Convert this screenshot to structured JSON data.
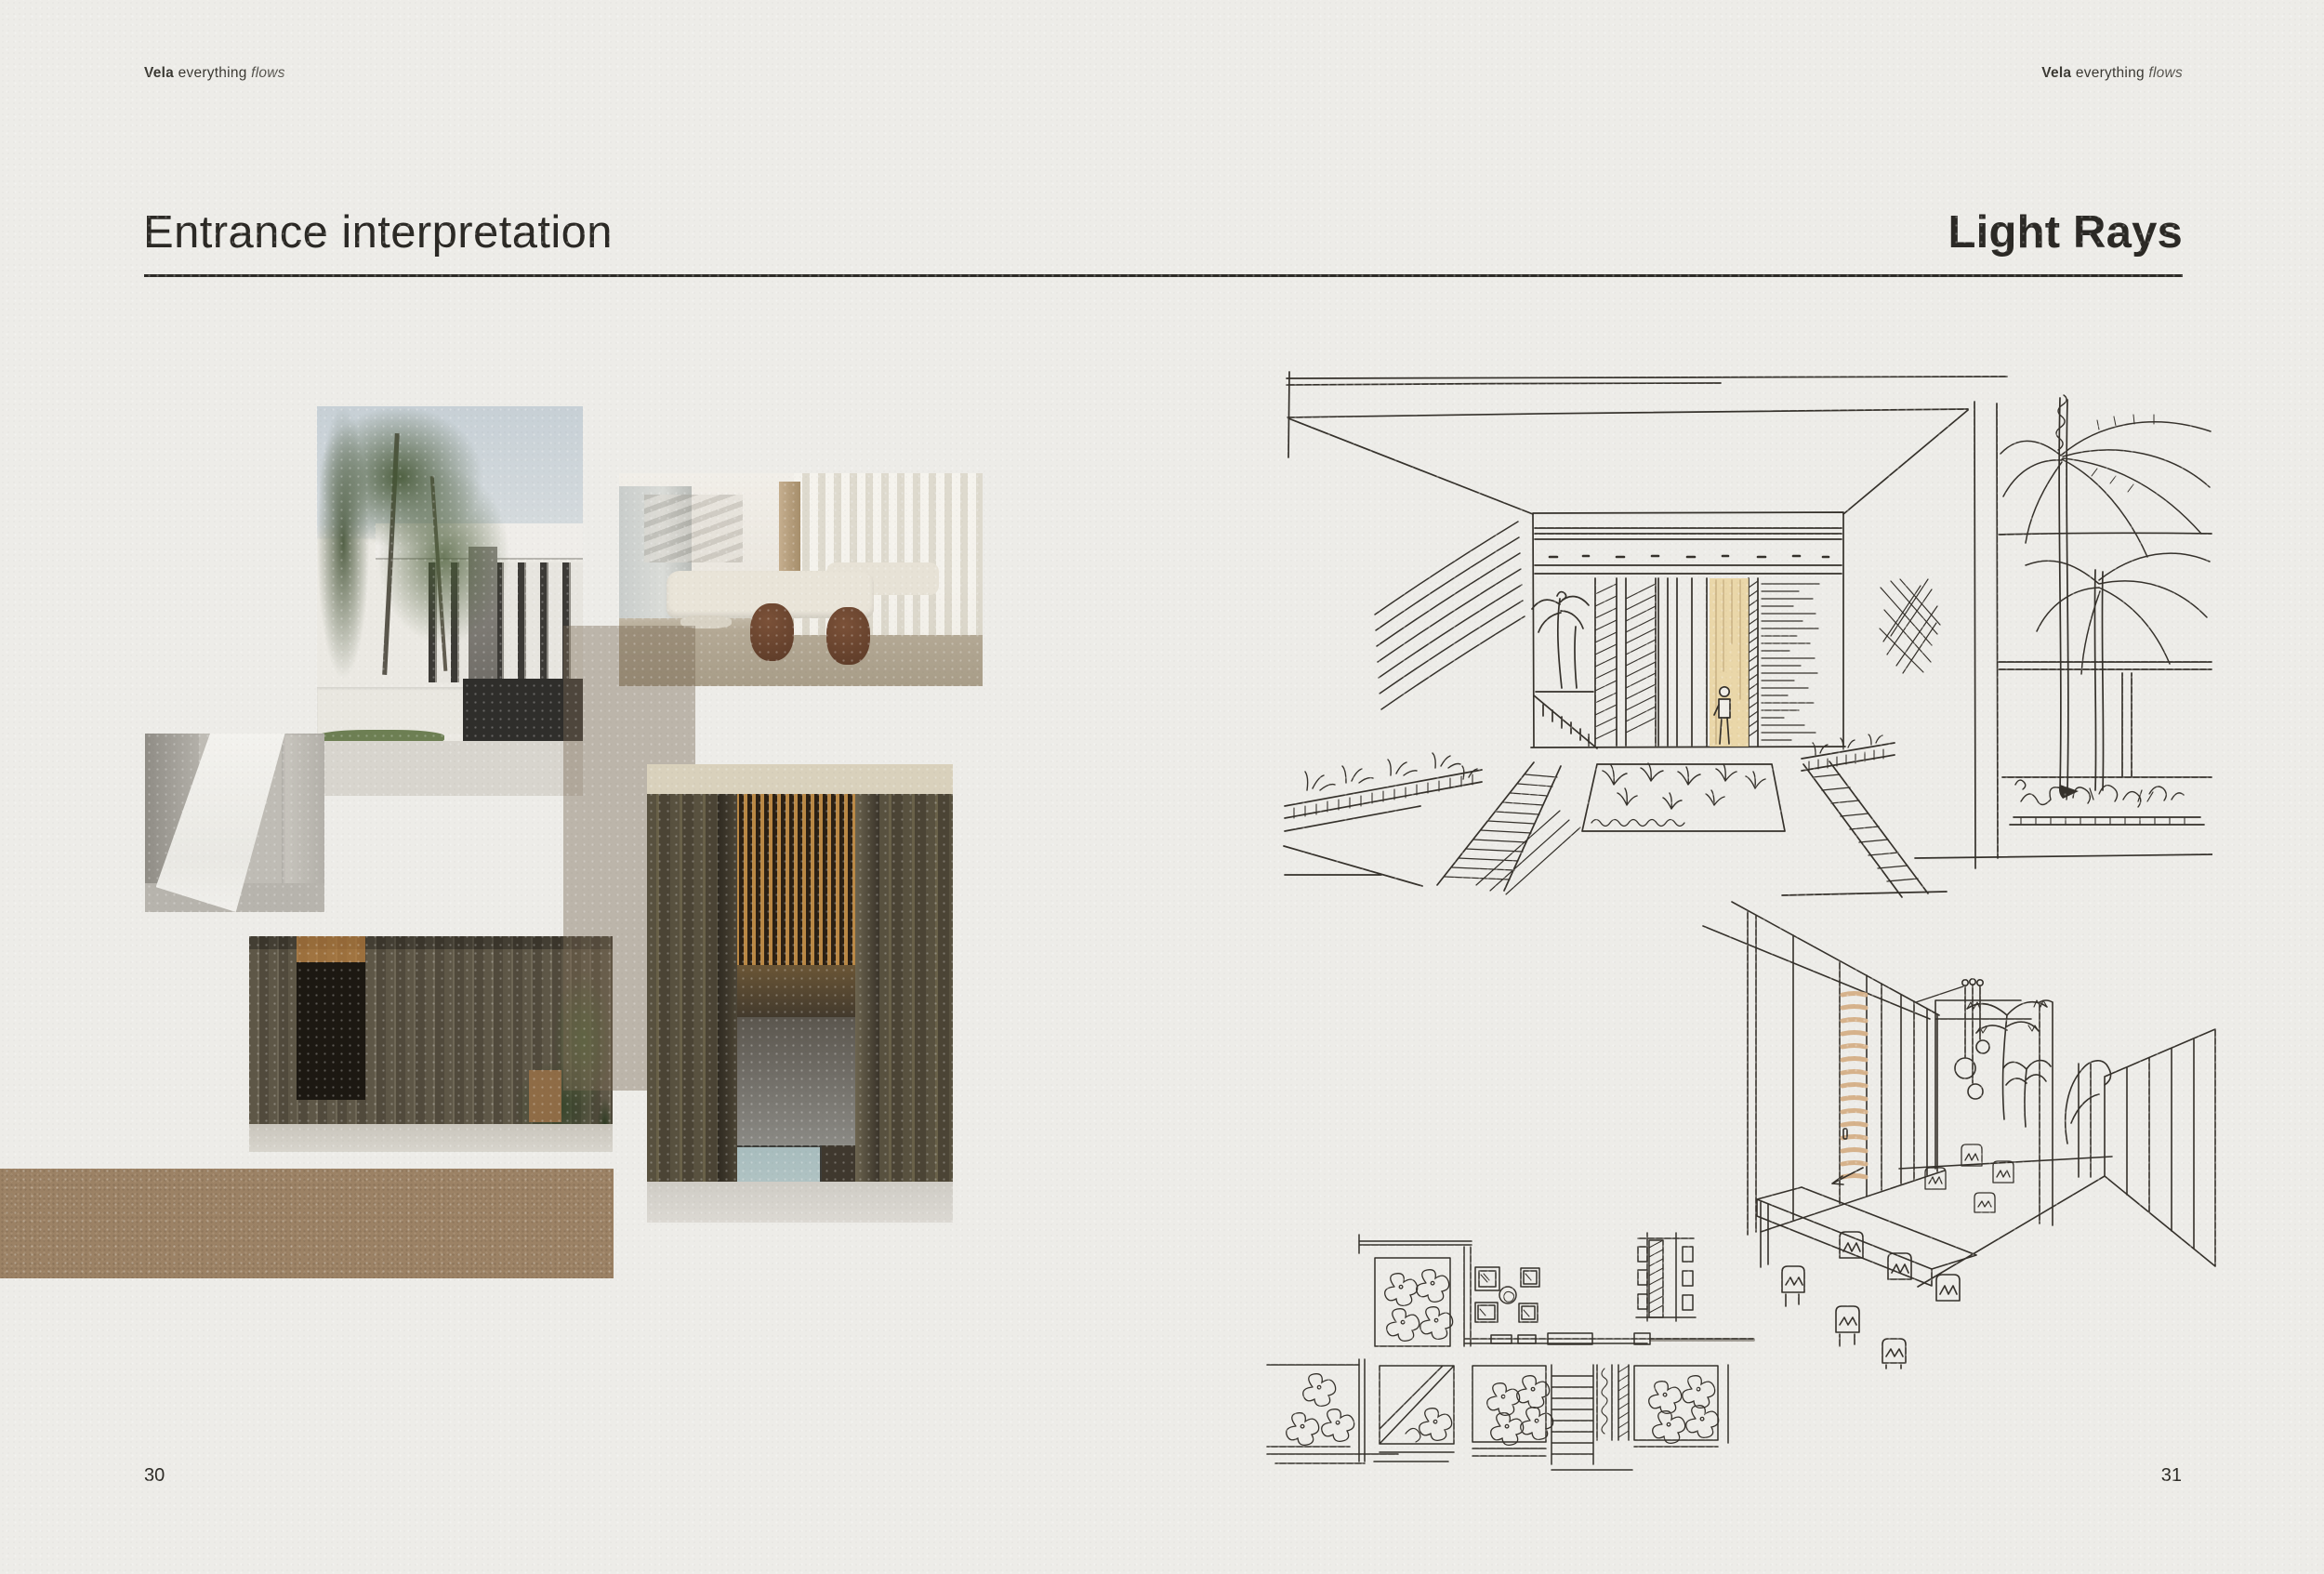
{
  "spread": {
    "left_page": {
      "logo": {
        "brand": "Vela",
        "tagline_word": "everything",
        "tagline_italic": "flows"
      },
      "heading": "Entrance interpretation",
      "page_number": "30",
      "moodboard": {
        "photos": [
          {
            "id": "villa-palms",
            "description": "White modern villa facade with palm trees"
          },
          {
            "id": "lobby-lounge",
            "description": "Double-height lounge with sheer curtains and curved sofas"
          },
          {
            "id": "concrete-light",
            "description": "Wedge of daylight across a concrete wall"
          },
          {
            "id": "timber-entrance",
            "description": "Bronze fluted entrance wall with planting"
          },
          {
            "id": "pivot-door",
            "description": "Full-height pivot door with glowing slatted timber ceiling"
          }
        ],
        "leather_swatch_color": "#9c8265",
        "overlay_tint": "rgba(122,106,84,0.42)"
      }
    },
    "right_page": {
      "logo": {
        "brand": "Vela",
        "tagline_word": "everything",
        "tagline_italic": "flows"
      },
      "heading": "Light Rays",
      "page_number": "31",
      "sketches": [
        {
          "id": "entrance-perspective",
          "description": "Ink sketch of entrance court with slatted door, planting beds and palms"
        },
        {
          "id": "interior-perspective",
          "description": "Ink sketch of interior gallery with long table, pendant lights and slatted walls"
        },
        {
          "id": "floor-plan-studies",
          "description": "Ink sketch plan studies with planting courts, furniture and stair"
        }
      ]
    },
    "style": {
      "paper": "#edece8",
      "ink": "#35312b",
      "rule": "#2d2b27",
      "door_tint": "#e9d49d"
    }
  }
}
